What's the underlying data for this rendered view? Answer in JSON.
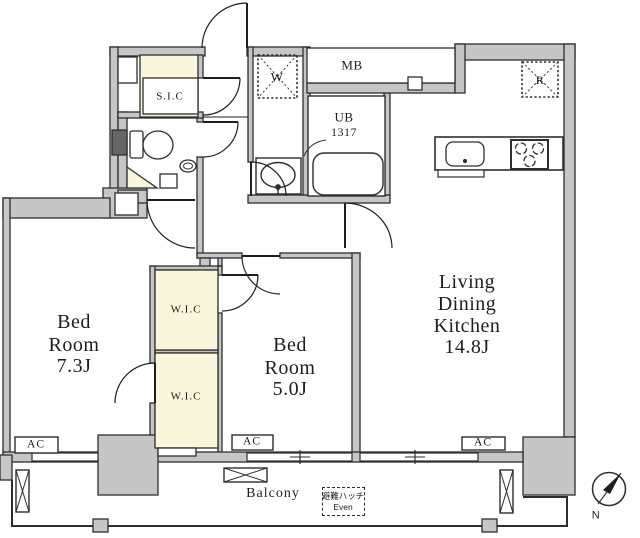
{
  "colors": {
    "wall": "#c6c6c6",
    "line": "#2e2e2e",
    "closet": "#faf6dc",
    "paper": "#ffffff",
    "dark": "#666666"
  },
  "rooms": {
    "ldk": {
      "line1": "Living",
      "line2": "Dining",
      "line3": "Kitchen",
      "size": "14.8J"
    },
    "bedroom1": {
      "line1": "Bed",
      "line2": "Room",
      "size": "7.3J"
    },
    "bedroom2": {
      "line1": "Bed",
      "line2": "Room",
      "size": "5.0J"
    }
  },
  "storage": {
    "shoe_closet": "S.I.C",
    "walk_in_closet_upper": "W.I.C",
    "walk_in_closet_lower": "W.I.C"
  },
  "fixtures": {
    "washing_machine": "W",
    "meter_box": "MB",
    "unit_bath": "UB",
    "unit_bath_size": "1317",
    "refrigerator": "R"
  },
  "equipment": {
    "ac_left": "AC",
    "ac_middle": "AC",
    "ac_right": "AC"
  },
  "outdoor": {
    "balcony": "Balcony",
    "hatch_label": "避難ハッチ",
    "hatch_sub": "Even"
  },
  "compass": {
    "north": "N"
  }
}
